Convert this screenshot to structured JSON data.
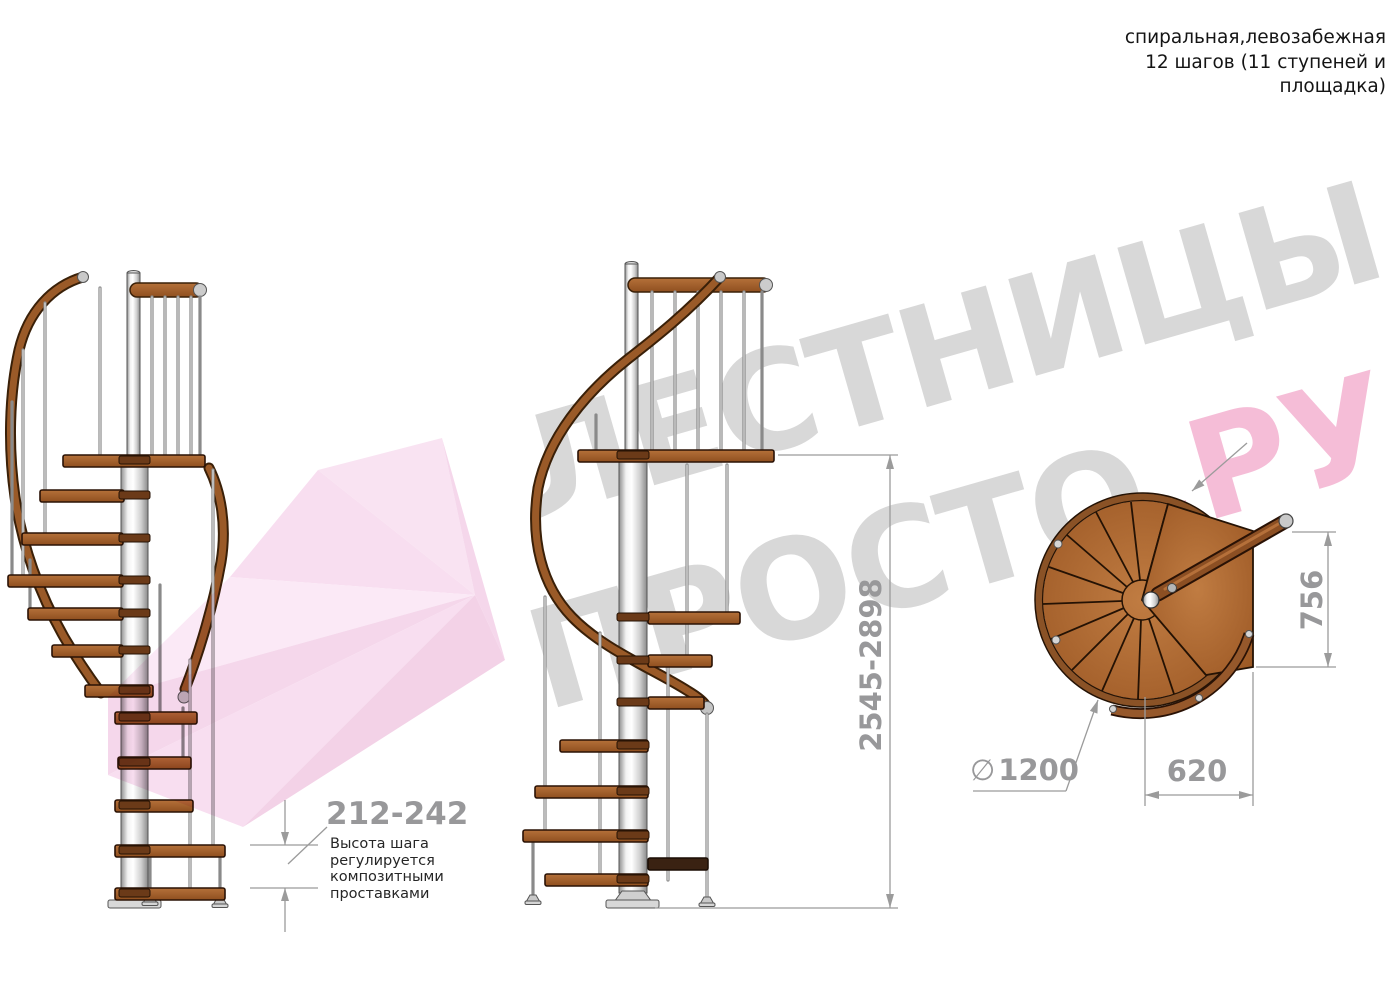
{
  "header_note": {
    "lines": [
      "спиральная,левозабежная",
      "12 шагов (11 ступеней и",
      "площадка)"
    ]
  },
  "watermark": {
    "word1": "ЛЕСТНИЦЫ",
    "word2_gray": "ПРОСТО",
    "word2_pink": ".РУ"
  },
  "dimensions": {
    "step_height": "212-242",
    "step_height_note": [
      "Высота шага",
      "регулируется",
      "композитными",
      "проставками"
    ],
    "total_height": "2545-2898",
    "landing_depth": "756",
    "step_width": "620",
    "diameter_symbol": "∅",
    "diameter_value": "1200"
  },
  "colors": {
    "wood": "#a5612c",
    "wood_dark": "#6b3a18",
    "handrail": "#9a5a28",
    "metal": "#e8e8e8",
    "dimension_gray": "#98989a",
    "watermark_gray": "#d8d8d8",
    "watermark_pink": "#f5bdd7",
    "logo_pink": "#f7ddef"
  }
}
